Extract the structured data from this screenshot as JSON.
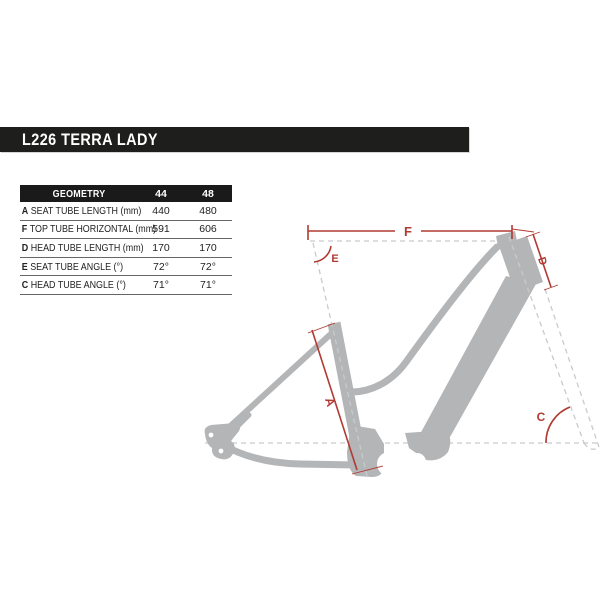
{
  "page_title": "L226 TERRA LADY",
  "table": {
    "header": {
      "name": "GEOMETRY",
      "col1": "44",
      "col2": "48"
    },
    "rows": [
      {
        "letter": "A",
        "label": "SEAT TUBE LENGTH (mm)",
        "v44": "440",
        "v48": "480"
      },
      {
        "letter": "F",
        "label": "TOP TUBE HORIZONTAL (mm)",
        "v44": "591",
        "v48": "606"
      },
      {
        "letter": "D",
        "label": "HEAD TUBE LENGTH (mm)",
        "v44": "170",
        "v48": "170"
      },
      {
        "letter": "E",
        "label": "SEAT TUBE ANGLE (°)",
        "v44": "72°",
        "v48": "72°"
      },
      {
        "letter": "C",
        "label": "HEAD TUBE ANGLE (°)",
        "v44": "71°",
        "v48": "71°"
      }
    ]
  },
  "diagram": {
    "labels": {
      "top_tube_horizontal": "F",
      "seat_tube_angle": "E",
      "head_tube_length": "D",
      "seat_tube_length": "A",
      "head_tube_angle": "C"
    },
    "colors": {
      "dimension_red": "#b13a33",
      "frame_gray": "#b3b5b7",
      "dash_gray": "#c8cacc",
      "bar_black": "#1e1e1c"
    }
  }
}
